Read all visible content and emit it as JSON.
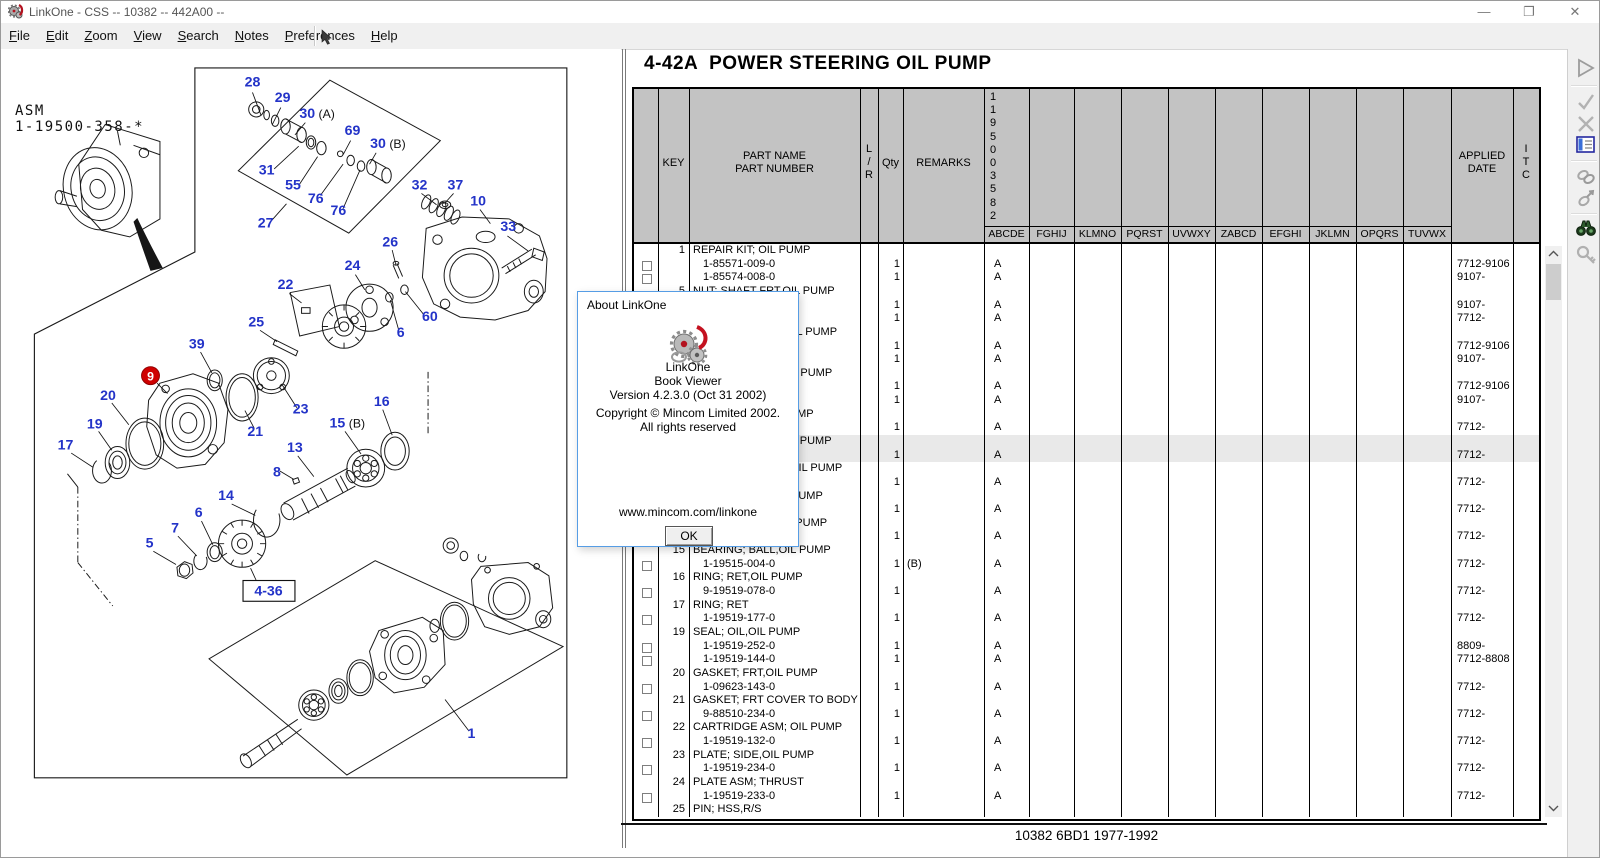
{
  "window": {
    "title": "LinkOne - CSS -- 10382 -- 442A00 --",
    "controls": {
      "minimize": "—",
      "restore": "❐",
      "close": "✕"
    }
  },
  "menu": {
    "items": [
      "File",
      "Edit",
      "Zoom",
      "View",
      "Search",
      "Notes",
      "Preferences",
      "Help"
    ]
  },
  "toolbar_right": {
    "icons": [
      "play",
      "confirm",
      "cancel",
      "parts-list",
      "link",
      "link-attach",
      "binoculars",
      "zoom-key"
    ]
  },
  "diagram": {
    "asm_label": "ASM\n1-19500-358-*",
    "figure_code": "442A0110382",
    "ref_box_label": "4-36",
    "red_badge": {
      "n": "9",
      "x": 140,
      "y": 394
    },
    "callouts": [
      {
        "n": "28",
        "x": 248,
        "y": 88
      },
      {
        "n": "29",
        "x": 280,
        "y": 104
      },
      {
        "n": "30",
        "x": 306,
        "y": 121,
        "suffix": "(A)"
      },
      {
        "n": "69",
        "x": 354,
        "y": 139
      },
      {
        "n": "30",
        "x": 381,
        "y": 153,
        "suffix": "(B)"
      },
      {
        "n": "31",
        "x": 263,
        "y": 181
      },
      {
        "n": "55",
        "x": 291,
        "y": 197
      },
      {
        "n": "76",
        "x": 315,
        "y": 211
      },
      {
        "n": "76",
        "x": 339,
        "y": 224
      },
      {
        "n": "27",
        "x": 262,
        "y": 237
      },
      {
        "n": "32",
        "x": 425,
        "y": 197
      },
      {
        "n": "37",
        "x": 463,
        "y": 197
      },
      {
        "n": "10",
        "x": 487,
        "y": 214
      },
      {
        "n": "33",
        "x": 519,
        "y": 241
      },
      {
        "n": "26",
        "x": 394,
        "y": 257
      },
      {
        "n": "24",
        "x": 354,
        "y": 282
      },
      {
        "n": "22",
        "x": 283,
        "y": 302
      },
      {
        "n": "60",
        "x": 436,
        "y": 336
      },
      {
        "n": "6",
        "x": 405,
        "y": 353
      },
      {
        "n": "25",
        "x": 252,
        "y": 342
      },
      {
        "n": "39",
        "x": 189,
        "y": 365
      },
      {
        "n": "20",
        "x": 95,
        "y": 420
      },
      {
        "n": "19",
        "x": 81,
        "y": 450
      },
      {
        "n": "17",
        "x": 50,
        "y": 472
      },
      {
        "n": "23",
        "x": 299,
        "y": 434
      },
      {
        "n": "21",
        "x": 251,
        "y": 458
      },
      {
        "n": "16",
        "x": 385,
        "y": 426
      },
      {
        "n": "15",
        "x": 338,
        "y": 449,
        "suffix": "(B)"
      },
      {
        "n": "13",
        "x": 293,
        "y": 475
      },
      {
        "n": "8",
        "x": 274,
        "y": 501
      },
      {
        "n": "14",
        "x": 220,
        "y": 526
      },
      {
        "n": "6",
        "x": 191,
        "y": 544
      },
      {
        "n": "7",
        "x": 166,
        "y": 560
      },
      {
        "n": "5",
        "x": 139,
        "y": 576
      },
      {
        "n": "1",
        "x": 480,
        "y": 778
      }
    ]
  },
  "table": {
    "title": "4-42A  POWER STEERING OIL PUMP",
    "headers": {
      "key": "KEY",
      "part": "PART NAME\nPART NUMBER",
      "lr": "L\n/\nR",
      "qty": "Qty",
      "remarks": "REMARKS",
      "applied": "APPLIED\nDATE",
      "itc": "I\nT\nC",
      "model_vertical": "1195003582",
      "applicability": [
        "ABCDE",
        "FGHIJ",
        "KLMNO",
        "PQRST",
        "UVWXY",
        "ZABCD",
        "EFGHI",
        "JKLMN",
        "OPQRS",
        "TUVWX"
      ]
    },
    "groups": [
      {
        "key": "1",
        "name": "REPAIR KIT; OIL PUMP",
        "parts": [
          {
            "num": "1-85571-009-0",
            "qty": "1",
            "rem": "",
            "app": "A",
            "date": "7712-9106"
          },
          {
            "num": "1-85574-008-0",
            "qty": "1",
            "rem": "",
            "app": "A",
            "date": "9107-"
          }
        ]
      },
      {
        "key": "5",
        "name": "NUT; SHAFT FRT,OIL PUMP",
        "parts": [
          {
            "num": "1-09915-022-0",
            "qty": "1",
            "rem": "",
            "app": "A",
            "date": "9107-"
          },
          {
            "num": "1-09915-014-0",
            "qty": "1",
            "rem": "",
            "app": "A",
            "date": "7712-"
          }
        ]
      },
      {
        "key": "6",
        "name": "WASHER; SHAFT,OIL PUMP",
        "parts": [
          {
            "num": "1-19517-011-0",
            "qty": "1",
            "rem": "",
            "app": "A",
            "date": "7712-9106"
          },
          {
            "num": "1-19517-012-0",
            "qty": "1",
            "rem": "",
            "app": "A",
            "date": "9107-"
          }
        ]
      },
      {
        "key": "7",
        "name": "WASHER; LOCK,OIL PUMP",
        "parts": [
          {
            "num": "1-19517-013-0",
            "qty": "1",
            "rem": "",
            "app": "A",
            "date": "7712-9106"
          },
          {
            "num": "1-19517-014-0",
            "qty": "1",
            "rem": "",
            "app": "A",
            "date": "9107-"
          }
        ]
      },
      {
        "key": "8",
        "name": "CLIP; SHAFT,OIL PUMP",
        "parts": [
          {
            "num": "1-19517-015-0",
            "qty": "1",
            "rem": "",
            "app": "A",
            "date": "7712-"
          }
        ]
      },
      {
        "key": "9",
        "name": "BODY ASM; FRT,OIL PUMP",
        "highlighted": true,
        "parts": [
          {
            "num": "1-19519-128-0",
            "qty": "1",
            "rem": "",
            "app": "A",
            "date": "7712-"
          }
        ]
      },
      {
        "key": "10",
        "name": "BODY ASM; REAR,OIL PUMP",
        "parts": [
          {
            "num": "1-19519-129-0",
            "qty": "1",
            "rem": "",
            "app": "A",
            "date": "7712-"
          }
        ]
      },
      {
        "key": "13",
        "name": "SHAFT; DRIVE,OIL PUMP",
        "parts": [
          {
            "num": "1-19519-130-0",
            "qty": "1",
            "rem": "",
            "app": "A",
            "date": "7712-"
          }
        ]
      },
      {
        "key": "14",
        "name": "GEAR; DRIVEN,OIL PUMP",
        "parts": [
          {
            "num": "1-19519-131-0",
            "qty": "1",
            "rem": "",
            "app": "A",
            "date": "7712-"
          }
        ]
      },
      {
        "key": "15",
        "name": "BEARING; BALL,OIL PUMP",
        "parts": [
          {
            "num": "1-19515-004-0",
            "qty": "1",
            "rem": "(B)",
            "app": "A",
            "date": "7712-"
          }
        ]
      },
      {
        "key": "16",
        "name": "RING; RET,OIL PUMP",
        "parts": [
          {
            "num": "9-19519-078-0",
            "qty": "1",
            "rem": "",
            "app": "A",
            "date": "7712-"
          }
        ]
      },
      {
        "key": "17",
        "name": "RING; RET",
        "parts": [
          {
            "num": "1-19519-177-0",
            "qty": "1",
            "rem": "",
            "app": "A",
            "date": "7712-"
          }
        ]
      },
      {
        "key": "19",
        "name": "SEAL; OIL,OIL PUMP",
        "parts": [
          {
            "num": "1-19519-252-0",
            "qty": "1",
            "rem": "",
            "app": "A",
            "date": "8809-"
          },
          {
            "num": "1-19519-144-0",
            "qty": "1",
            "rem": "",
            "app": "A",
            "date": "7712-8808"
          }
        ]
      },
      {
        "key": "20",
        "name": "GASKET; FRT,OIL PUMP",
        "parts": [
          {
            "num": "1-09623-143-0",
            "qty": "1",
            "rem": "",
            "app": "A",
            "date": "7712-"
          }
        ]
      },
      {
        "key": "21",
        "name": "GASKET; FRT COVER TO BODY",
        "parts": [
          {
            "num": "9-88510-234-0",
            "qty": "1",
            "rem": "",
            "app": "A",
            "date": "7712-"
          }
        ]
      },
      {
        "key": "22",
        "name": "CARTRIDGE ASM; OIL PUMP",
        "parts": [
          {
            "num": "1-19519-132-0",
            "qty": "1",
            "rem": "",
            "app": "A",
            "date": "7712-"
          }
        ]
      },
      {
        "key": "23",
        "name": "PLATE; SIDE,OIL PUMP",
        "parts": [
          {
            "num": "1-19519-234-0",
            "qty": "1",
            "rem": "",
            "app": "A",
            "date": "7712-"
          }
        ]
      },
      {
        "key": "24",
        "name": "PLATE ASM; THRUST",
        "parts": [
          {
            "num": "1-19519-233-0",
            "qty": "1",
            "rem": "",
            "app": "A",
            "date": "7712-"
          }
        ]
      },
      {
        "key": "25",
        "name": "PIN; HSS,R/S",
        "parts": []
      }
    ],
    "status": "10382 6BD1 1977-1992"
  },
  "dialog": {
    "title": "About LinkOne",
    "product": "LinkOne",
    "subtitle": "Book Viewer",
    "version": "Version 4.2.3.0 (Oct 31 2002)",
    "copyright": "Copyright © Mincom Limited 2002.",
    "rights": "All rights reserved",
    "url": "www.mincom.com/linkone",
    "ok_label": "OK"
  },
  "colors": {
    "callout_blue": "#2333c8",
    "badge_red": "#cf0000",
    "header_gray": "#c3c3c3",
    "highlight": "#e9e9e9"
  }
}
